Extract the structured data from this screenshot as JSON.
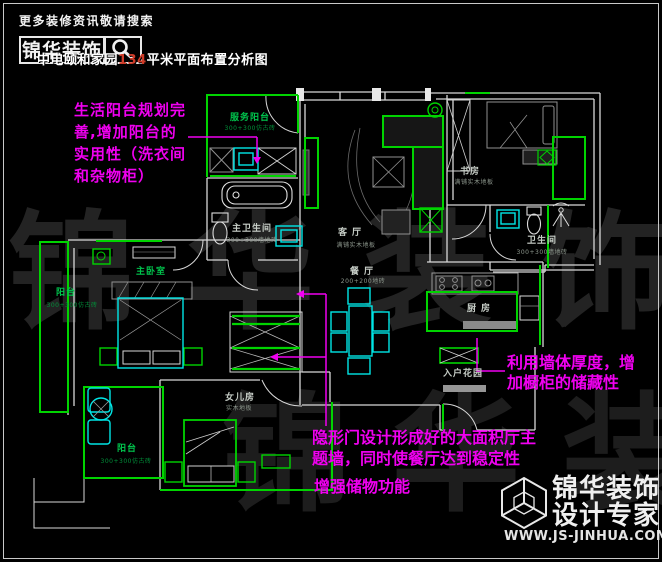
{
  "header": {
    "tagline": "更多装修资讯敬请搜索",
    "brand": "锦华装饰",
    "search_icon": "magnifier",
    "title_prefix": "中电颐和家园",
    "title_number": "134",
    "title_suffix": "平米平面布置分析图"
  },
  "rooms": [
    {
      "name": "服务阳台",
      "sub": "300+300仿古砖"
    },
    {
      "name": "主卫生间",
      "sub": "300+300墙地砖"
    },
    {
      "name": "主卧室",
      "sub": ""
    },
    {
      "name": "阳台",
      "sub": "300+300仿古砖"
    },
    {
      "name": "阳台",
      "sub": "300+300仿古砖"
    },
    {
      "name": "女儿房",
      "sub": "实木地板"
    },
    {
      "name": "客厅",
      "sub": "满铺实木地板"
    },
    {
      "name": "餐厅",
      "sub": "200+200地砖"
    },
    {
      "name": "厨房",
      "sub": ""
    },
    {
      "name": "入户花园",
      "sub": ""
    },
    {
      "name": "卫生间",
      "sub": "300+300墙地砖"
    },
    {
      "name": "书房",
      "sub": "满铺实木地板"
    }
  ],
  "annotations": {
    "left": {
      "lines": [
        "生活阳台规划完",
        "善,增加阳台的",
        "实用性（洗衣间",
        "和杂物柜）"
      ]
    },
    "right": {
      "lines": [
        "利用墙体厚度，增",
        "加橱柜的储藏性"
      ]
    },
    "bottom": {
      "lines": [
        "隐形门设计形成好的大面积厅主",
        "题墙，同时使餐厅达到稳定性"
      ]
    },
    "storage": "增强储物功能"
  },
  "watermark": {
    "text": "锦华装饰"
  },
  "footer": {
    "brand_line1": "锦华装饰",
    "brand_line2": "设计专家",
    "url": "WWW.JS-JINHUA.COM",
    "logo_icon": "wireframe-cube"
  },
  "colors": {
    "wall_green": "#00d400",
    "fixture_cyan": "#00e6e6",
    "annotation_magenta": "#f000f0",
    "title_number_red": "#cf3b28",
    "background": "#000000"
  }
}
